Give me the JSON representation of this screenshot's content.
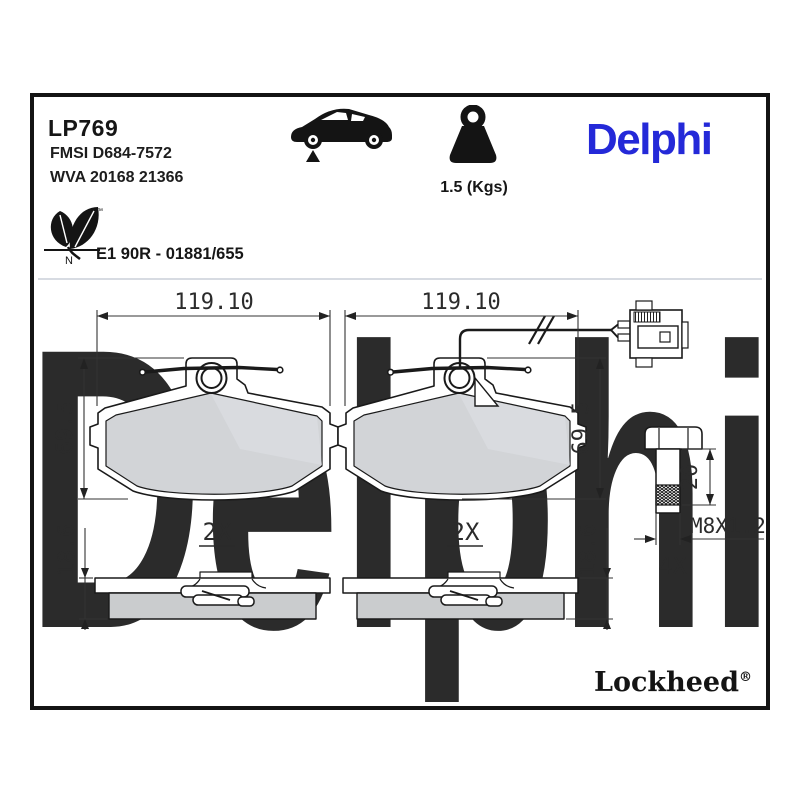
{
  "header": {
    "part_number": "LP769",
    "fmsi_ref": "FMSI D684-7572",
    "wva_ref": "WVA 20168 21366",
    "weight": "1.5 (Kgs)",
    "brand_logo": "Delphi",
    "eco_tm": "™",
    "eco_letter": "N",
    "approval": "E1 90R - 01881/655",
    "icons": [
      "car-side-silhouette-icon",
      "weight-kettlebell-icon",
      "eco-leaf-icon"
    ]
  },
  "watermark": "Delphi",
  "drawing": {
    "pads": [
      {
        "view": "front",
        "width_dim": "119.10",
        "height_dim": "69.5",
        "qty": "2X",
        "thickness_dim": "18.6"
      },
      {
        "view": "front-with-wear-sensor",
        "width_dim": "119.10",
        "height_dim": "69.5",
        "qty": "2X",
        "thickness_dim": "18.6"
      }
    ],
    "bolt": {
      "length_dim": "20",
      "thread": "M8X1.25",
      "qty": "4X"
    }
  },
  "footer": {
    "brand": "Lockheed",
    "registered": "®"
  },
  "colors": {
    "brand_blue": "#2429d8",
    "pad_fill": "#d2d4d7",
    "friction_side_fill": "#caccce",
    "watermark": "#e7ebf3"
  }
}
